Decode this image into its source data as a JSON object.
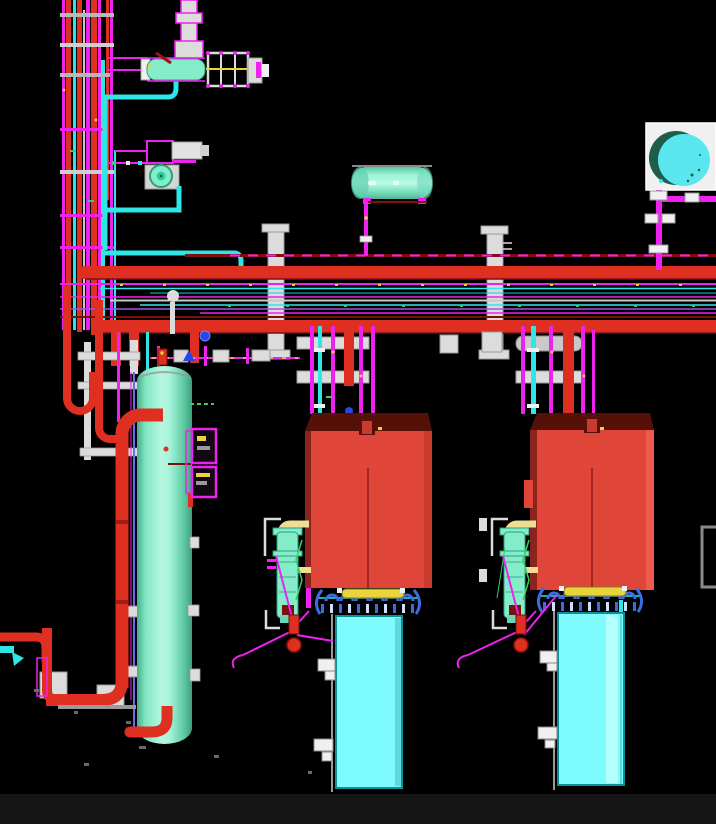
{
  "viewport": {
    "kind": "3d-plant-model-view",
    "width": 716,
    "height": 824,
    "background": "#000000"
  },
  "palette": {
    "background": "#000000",
    "bottom_bar": "#151515",
    "red_pipe": "#df2f20",
    "dark_red": "#7a1010",
    "maroon_top": "#551007",
    "equipment_red": "#e0453a",
    "equipment_red_edge": "#8a241c",
    "equipment_red_dark": "#c93a2f",
    "equipment_red_light": "#ef5a4e",
    "magenta": "#ee22ee",
    "purple": "#a055e8",
    "cyan_line": "#2ee6e6",
    "teal_line": "#0fd0d0",
    "vessel_mint": "#84ecc9",
    "cyan_box": "#7efbfd",
    "cyan_box_edge": "#0e8e96",
    "cyan_box_shade": "#5fd9de",
    "cyan_box_light": "#b5fefe",
    "tank_cyan": "#59e6ef",
    "tank_green": "#1e5e49",
    "steel_white": "#dcdcdc",
    "steel_gray": "#9a9a9a",
    "yellow": "#e8d43c",
    "pale_yellow": "#eedd92",
    "blue": "#2a46e8",
    "manifold_blue": "#3b6ce0",
    "manifold_tick": "#cfe0ff",
    "green": "#35d060",
    "blue_violet": "#6a6af0",
    "white": "#f0f0f0"
  },
  "equipment": [
    {
      "name": "vertical-vessel",
      "color": "#84ecc9"
    },
    {
      "name": "overhead-drum",
      "color": "#84ecc9"
    },
    {
      "name": "storage-tank-top-view",
      "color": "#59e6ef"
    },
    {
      "name": "pump-assembly",
      "color": "#84ecc9"
    },
    {
      "name": "top-exchanger-assembly",
      "color": "#84ecc9"
    },
    {
      "name": "equipment-box-left",
      "color": "#e0453a"
    },
    {
      "name": "equipment-box-right",
      "color": "#e0453a"
    },
    {
      "name": "skid-box-left",
      "color": "#7efbfd"
    },
    {
      "name": "skid-box-right",
      "color": "#7efbfd"
    },
    {
      "name": "filter-assembly-left",
      "color": "#84ecc9"
    },
    {
      "name": "filter-assembly-right",
      "color": "#84ecc9"
    },
    {
      "name": "pipe-rack",
      "color": "#df2f20"
    },
    {
      "name": "pipe-bundle-vertical",
      "color": "#df2f20"
    }
  ]
}
